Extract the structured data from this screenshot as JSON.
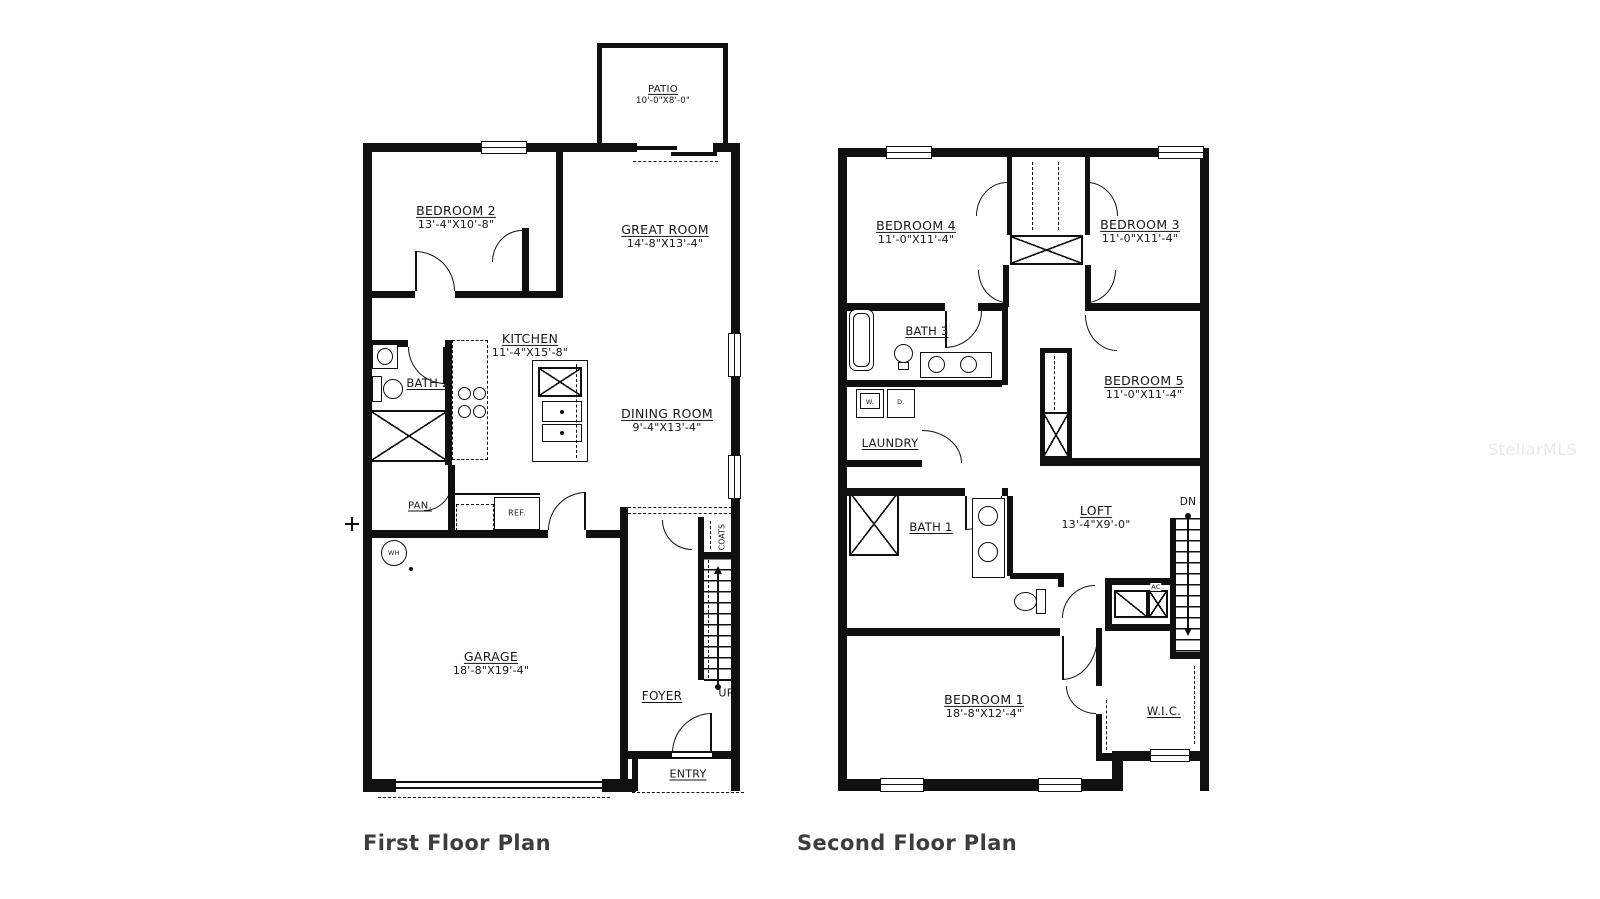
{
  "watermark": "StellarMLS",
  "first_floor": {
    "title": "First Floor Plan",
    "patio": {
      "name": "PATIO",
      "dims": "10'-0\"X8'-0\""
    },
    "bedroom2": {
      "name": "BEDROOM 2",
      "dims": "13'-4\"X10'-8\""
    },
    "great_room": {
      "name": "GREAT ROOM",
      "dims": "14'-8\"X13'-4\""
    },
    "kitchen": {
      "name": "KITCHEN",
      "dims": "11'-4\"X15'-8\""
    },
    "bath2": {
      "name": "BATH 2"
    },
    "dining": {
      "name": "DINING ROOM",
      "dims": "9'-4\"X13'-4\""
    },
    "pantry": {
      "name": "PAN."
    },
    "fridge": {
      "name": "REF."
    },
    "water_heater": {
      "name": "WH"
    },
    "garage": {
      "name": "GARAGE",
      "dims": "18'-8\"X19'-4\""
    },
    "foyer": {
      "name": "FOYER"
    },
    "coats": {
      "name": "COATS"
    },
    "up": {
      "name": "UP"
    },
    "entry": {
      "name": "ENTRY"
    }
  },
  "second_floor": {
    "title": "Second Floor Plan",
    "bedroom4": {
      "name": "BEDROOM 4",
      "dims": "11'-0\"X11'-4\""
    },
    "bedroom3": {
      "name": "BEDROOM 3",
      "dims": "11'-0\"X11'-4\""
    },
    "bath3": {
      "name": "BATH 3"
    },
    "bedroom5": {
      "name": "BEDROOM 5",
      "dims": "11'-0\"X11'-4\""
    },
    "laundry": {
      "name": "LAUNDRY",
      "washer": "W.",
      "dryer": "D."
    },
    "bath1": {
      "name": "BATH 1"
    },
    "loft": {
      "name": "LOFT",
      "dims": "13'-4\"X9'-0\""
    },
    "dn": {
      "name": "DN"
    },
    "ac": {
      "name": "AC"
    },
    "bedroom1": {
      "name": "BEDROOM 1",
      "dims": "18'-8\"X12'-4\""
    },
    "wic": {
      "name": "W.I.C."
    }
  }
}
